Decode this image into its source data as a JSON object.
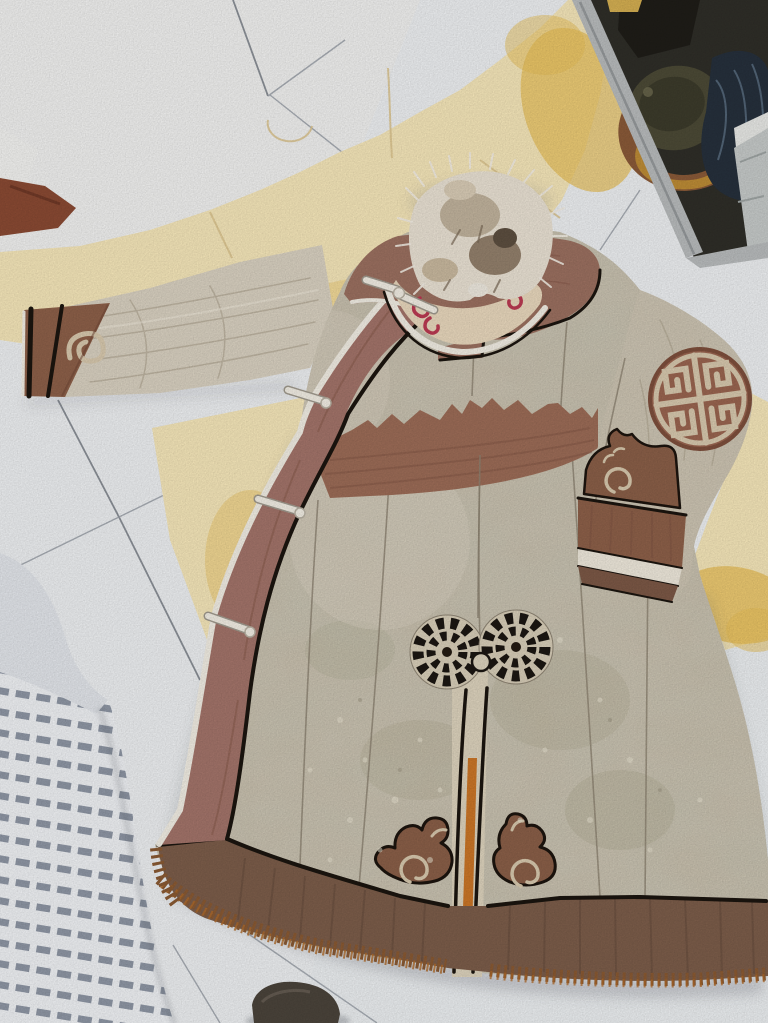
{
  "scene": {
    "description": "Photograph: traditional fur-collared hide robe (deel) laid flat on a white tiled floor, surrounded by tanned yellow hides, striped bedding at lower left, metal shelf with pots and bags at upper right, dark shoe at bottom",
    "objects": {
      "robe": "fur-collared leather deel with brown trim, toggle ties, round longevity emblem on sleeve, scroll motifs and fringed hem",
      "hides": "pale yellow tanned hides spread on floor",
      "bedding": "white fabric with gray stripes",
      "shelf": "metal stand with pot, basket and dark plastic bag",
      "floor": "white ceramic tiles with gray grout",
      "shoe": "dark shoe toe at bottom edge"
    }
  },
  "palette": {
    "floor": "#eef0f2",
    "grout": "#9aa0a8",
    "hide_pale": "#f6e7ba",
    "hide_gold": "#e8bf58",
    "scrap_white": "#f3f3f1",
    "scrap_brown": "#8a4a33",
    "bed_plain": "#e3e6eb",
    "bed_stripe": "#8f97a5",
    "shelf_dark": "#2f2e28",
    "shelf_metal": "#b9bcbd",
    "pot_olive": "#4c4a36",
    "bag_navy": "#26303c",
    "basket_brown": "#8a5a38",
    "basket_gold": "#bd8c36",
    "box_gray": "#c6cac9",
    "robe_base": "#c9c0ae",
    "robe_green": "#a3a085",
    "sleeve_cream": "#d9d1c1",
    "yoke_brown": "#9b7060",
    "lapel_brown": "#a3746a",
    "waist_brown": "#9c6c57",
    "hem_brown": "#7c5d4a",
    "fringe_orange": "#b06a28",
    "cuff_brown": "#8d6049",
    "motif_brown": "#8a5f48",
    "motif_cream": "#d8c9ae",
    "piping_black": "#1b150f",
    "piping_white": "#f2eee4",
    "fur_light": "#eae2d4",
    "fur_mid": "#b7a78e",
    "fur_dark": "#6f5f4d",
    "collar_cream": "#e9d8bd",
    "collar_red": "#bb3a52",
    "vent_orange": "#c9711f",
    "shoe_dark": "#4b443b",
    "shadow": "#5a5e66"
  }
}
